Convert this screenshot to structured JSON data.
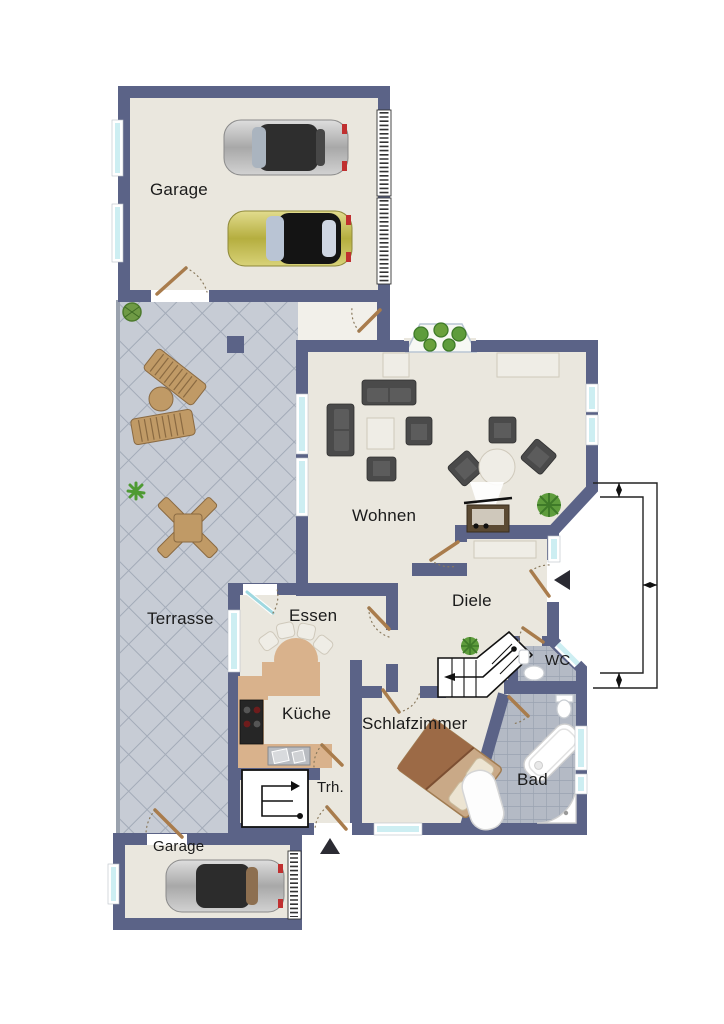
{
  "title": "Grundriss (floor plan)",
  "rooms": {
    "garage_top": "Garage",
    "terrasse": "Terrasse",
    "wohnen": "Wohnen",
    "essen": "Essen",
    "diele": "Diele",
    "wc": "WC",
    "kueche": "Küche",
    "schlafzimmer": "Schlafzimmer",
    "treppenhaus": "Trh.",
    "bad": "Bad",
    "garage_bottom": "Garage"
  },
  "colors": {
    "wall": "#5b6387",
    "floor": "#eae7de",
    "terrace_tile": "#c7ccd5",
    "terrace_grout": "#a3abb8",
    "bath_tile": "#b4bac5",
    "bath_grout": "#9aa3b1",
    "window_glass": "#cdeef2",
    "kitchen_counter": "#d9b28c",
    "door_leaf": "#a97c4c",
    "dark_furniture": "#4a4a4a",
    "light_furniture": "#efede6",
    "plant_green": "#5e9c3c",
    "stair_line": "#111111"
  },
  "icons": {
    "cars": [
      "silver-sports-car",
      "yellow-black-car",
      "silver-car"
    ],
    "fixtures": [
      "bathtub-icon",
      "shower-icon",
      "toilet-icon",
      "sink-icon",
      "stove-icon",
      "kitchen-sink-icon"
    ],
    "furniture": [
      "sofa-icon",
      "armchair-icon",
      "coffee-table-icon",
      "round-table-icon",
      "sideboard-icon",
      "piano-icon",
      "bed-icon",
      "dining-chair-icon",
      "lounger-icon",
      "patio-table-icon",
      "plant-icon"
    ],
    "symbols": [
      "stairs-icon",
      "stair-run-icon",
      "entrance-arrow-icon",
      "door-swing-icon",
      "dimension-lines",
      "garage-door-icon",
      "window-icon"
    ]
  }
}
